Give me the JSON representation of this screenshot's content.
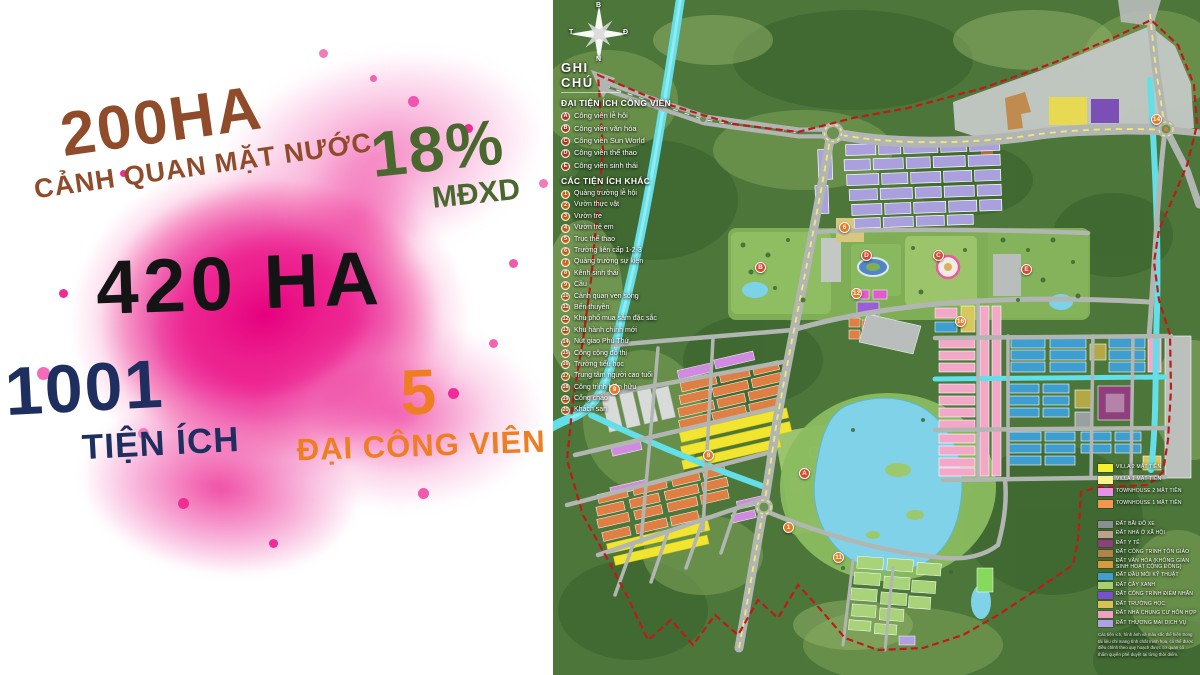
{
  "left_panel": {
    "water": {
      "value": "200HA",
      "label": "CẢNH QUAN MẶT NƯỚC"
    },
    "density": {
      "value": "18%",
      "label": "MĐXD"
    },
    "total_area": {
      "value": "420 HA"
    },
    "amenities": {
      "value": "1001",
      "label": "TIỆN ÍCH"
    },
    "parks": {
      "value": "5",
      "label": "ĐẠI CÔNG VIÊN"
    },
    "colors": {
      "brown": "#8f4b2a",
      "green": "#49682e",
      "black": "#141414",
      "navy": "#1d2e5f",
      "orange": "#ef7d22",
      "pink": "#ec1f92"
    }
  },
  "map": {
    "compass": {
      "north": "B",
      "south": "N",
      "west": "T",
      "east": "Đ"
    },
    "notes": {
      "title": "GHI CHÚ",
      "parks_section": {
        "title": "ĐẠI TIỆN ÍCH CÔNG VIÊN",
        "items": [
          {
            "badge": "A",
            "label": "Công viên lễ hội"
          },
          {
            "badge": "B",
            "label": "Công viên văn hóa"
          },
          {
            "badge": "C",
            "label": "Công viên Sun World"
          },
          {
            "badge": "D",
            "label": "Công viên thể thao"
          },
          {
            "badge": "E",
            "label": "Công viên sinh thái"
          }
        ]
      },
      "other_section": {
        "title": "CÁC TIỆN ÍCH KHÁC",
        "items": [
          {
            "badge": "1",
            "label": "Quảng trường lễ hội"
          },
          {
            "badge": "2",
            "label": "Vườn thực vật"
          },
          {
            "badge": "3",
            "label": "Vườn tre"
          },
          {
            "badge": "4",
            "label": "Vườn trẻ em"
          },
          {
            "badge": "5",
            "label": "Trục thể thao"
          },
          {
            "badge": "6",
            "label": "Trường liên cấp 1-2-3"
          },
          {
            "badge": "7",
            "label": "Quảng trường sự kiện"
          },
          {
            "badge": "8",
            "label": "Kênh sinh thái"
          },
          {
            "badge": "9",
            "label": "Cầu"
          },
          {
            "badge": "10",
            "label": "Cảnh quan ven sông"
          },
          {
            "badge": "11",
            "label": "Bến thuyền"
          },
          {
            "badge": "12",
            "label": "Khu phố mua sắm đặc sắc"
          },
          {
            "badge": "13",
            "label": "Khu hành chính mới"
          },
          {
            "badge": "14",
            "label": "Nút giao Phú Thứ"
          },
          {
            "badge": "15",
            "label": "Công cộng đô thị"
          },
          {
            "badge": "16",
            "label": "Trường tiểu học"
          },
          {
            "badge": "17",
            "label": "Trung tâm người cao tuổi"
          },
          {
            "badge": "18",
            "label": "Công trình hiện hữu"
          },
          {
            "badge": "19",
            "label": "Cổng chào"
          },
          {
            "badge": "20",
            "label": "Khách sạn"
          }
        ]
      }
    },
    "landuse_legend": {
      "housing": [
        {
          "color": "#f6ef2e",
          "label": "Villa 2 mặt tiền"
        },
        {
          "color": "#f7f38f",
          "label": "Villa 1 mặt tiền"
        },
        {
          "color": "#e690e8",
          "label": "Townhouse 2 mặt tiền"
        },
        {
          "color": "#f5954f",
          "label": "Townhouse 1 mặt tiền"
        }
      ],
      "land": [
        {
          "color": "#8a8f93",
          "label": "Đất bãi đỗ xe"
        },
        {
          "color": "#bfa08e",
          "label": "Đất nhà ở xã hội"
        },
        {
          "color": "#8e3f7c",
          "label": "Đất y tế"
        },
        {
          "color": "#b5804a",
          "label": "Đất công trình tôn giáo"
        },
        {
          "color": "#d99a3e",
          "label": "Đất văn hóa (không gian sinh hoạt cộng đồng)"
        },
        {
          "color": "#3e9fd0",
          "label": "Đất đầu mối kỹ thuật"
        },
        {
          "color": "#a8d06c",
          "label": "Đất cây xanh"
        },
        {
          "color": "#7a4fd0",
          "label": "Đất công trình điểm nhấn"
        },
        {
          "color": "#d9c252",
          "label": "Đất trường học"
        },
        {
          "color": "#f0a0c0",
          "label": "Đất nhà chung cư hỗn hợp"
        },
        {
          "color": "#b0a0e8",
          "label": "Đất thương mại dịch vụ"
        }
      ],
      "disclaimer": "Các tiện ích, hình ảnh và màu sắc thể hiện trong tài liệu chỉ mang tính chất minh họa, có thể được điều chỉnh theo quy hoạch được cơ quan có thẩm quyền phê duyệt tại từng thời điểm."
    }
  }
}
